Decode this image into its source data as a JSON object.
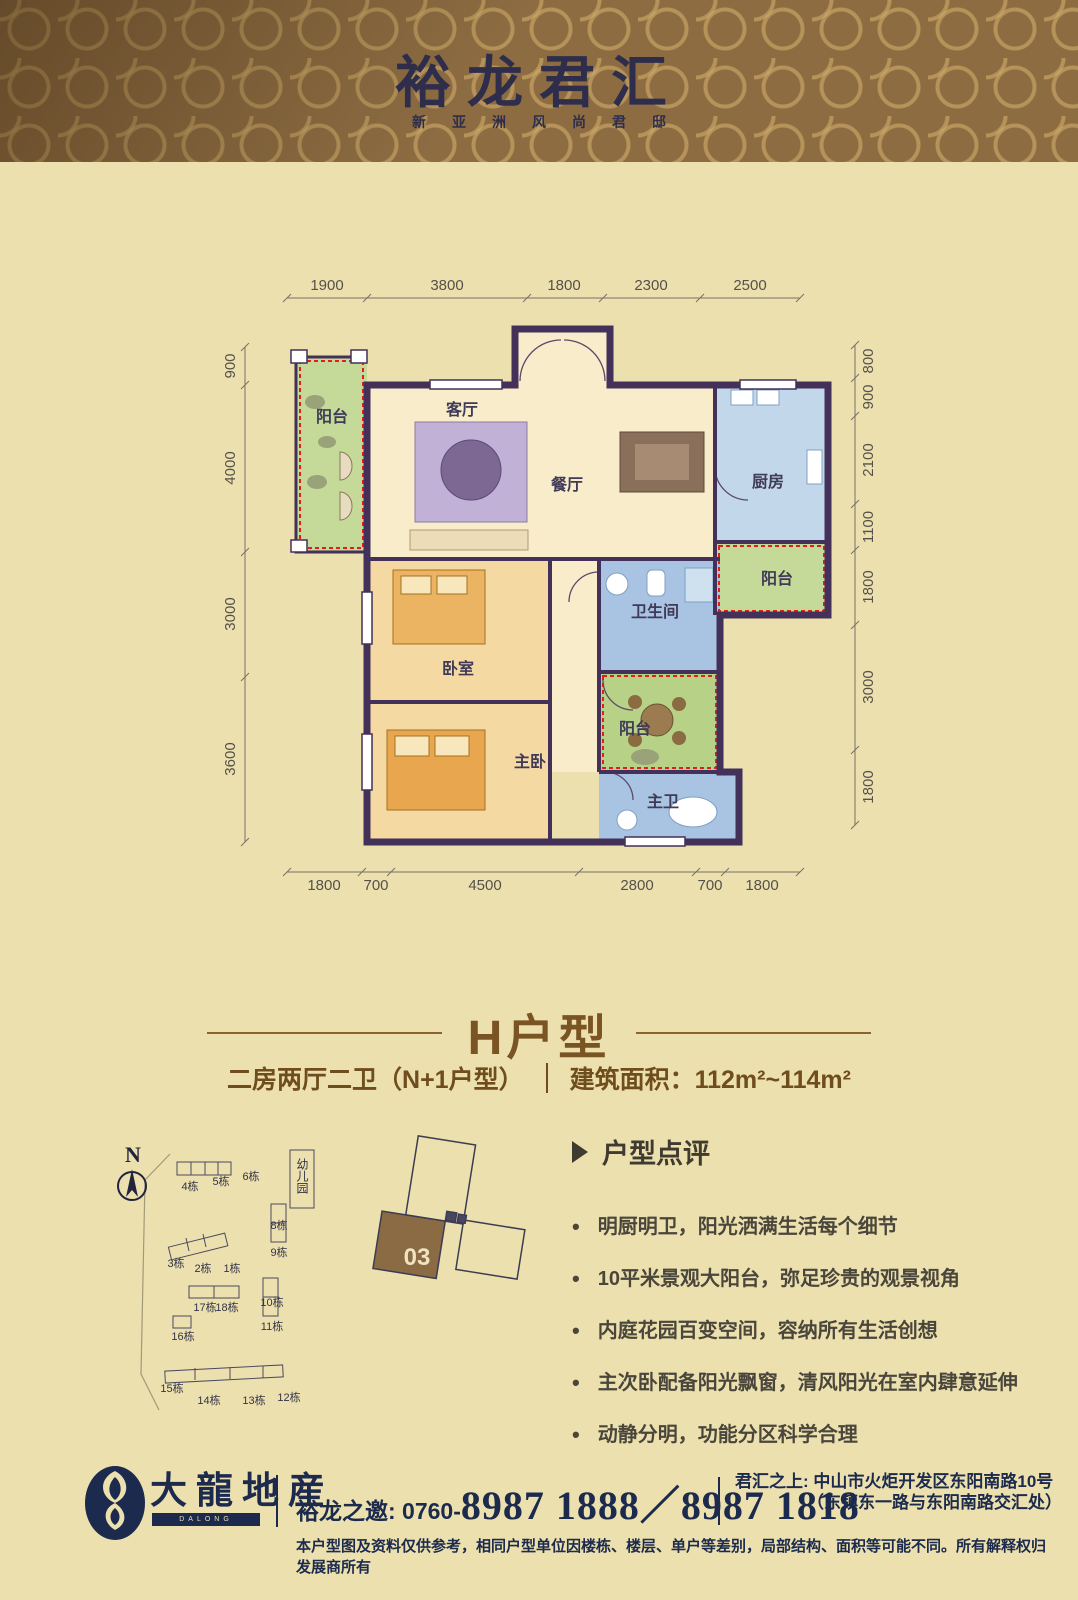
{
  "header": {
    "title": "裕龙君汇",
    "subtitle": "新亚洲风尚君邸",
    "bg_color": "#8d6c42",
    "pattern_color": "#d6b26c",
    "title_color": "#2e2e4c"
  },
  "floorplan": {
    "rooms": {
      "balcony_left": "阳台",
      "living": "客厅",
      "dining": "餐厅",
      "kitchen": "厨房",
      "balcony_kitchen": "阳台",
      "bathroom": "卫生间",
      "bedroom": "卧室",
      "balcony_mid": "阳台",
      "master_bedroom": "主卧",
      "master_bath": "主卫"
    },
    "dims_top": [
      "1900",
      "3800",
      "1800",
      "2300",
      "2500"
    ],
    "dims_left": [
      "900",
      "4000",
      "3000",
      "3600"
    ],
    "dims_right": [
      "800",
      "900",
      "2100",
      "1100",
      "1800",
      "3000",
      "1800"
    ],
    "dims_bottom": [
      "1800",
      "700",
      "4500",
      "2800",
      "700",
      "1800"
    ],
    "wall_color": "#43315a",
    "balcony_dash_color": "#e31e1e"
  },
  "section": {
    "title": "H户型",
    "spec": "二房两厅二卫（N+1户型）",
    "area": "建筑面积：112m²~114m²"
  },
  "siteplan": {
    "north": "N",
    "kindergarten": "幼儿园",
    "highlight_unit": "03",
    "buildings": [
      "4栋",
      "5栋",
      "6栋",
      "3栋",
      "2栋",
      "1栋",
      "8栋",
      "9栋",
      "10栋",
      "11栋",
      "17栋",
      "18栋",
      "16栋",
      "15栋",
      "14栋",
      "13栋",
      "12栋"
    ]
  },
  "comments": {
    "heading": "户型点评",
    "items": [
      "明厨明卫，阳光洒满生活每个细节",
      "10平米景观大阳台，弥足珍贵的观景视角",
      "内庭花园百变空间，容纳所有生活创想",
      "主次卧配备阳光飘窗，清风阳光在室内肆意延伸",
      "动静分明，功能分区科学合理"
    ]
  },
  "footer": {
    "logo_cn": "大龍地産",
    "logo_en": "DALONG TENEMENT",
    "phone_label": "裕龙之邀: 0760-",
    "phone_numbers": "8987 1888／8987 1818",
    "address_label": "君汇之上: ",
    "address_line1": "中山市火炬开发区东阳南路10号",
    "address_line2": "（东镇东一路与东阳南路交汇处）",
    "disclaimer": "本户型图及资料仅供参考，相同户型单位因楼栋、楼层、单户等差别，局部结构、面积等可能不同。所有解释权归发展商所有"
  }
}
